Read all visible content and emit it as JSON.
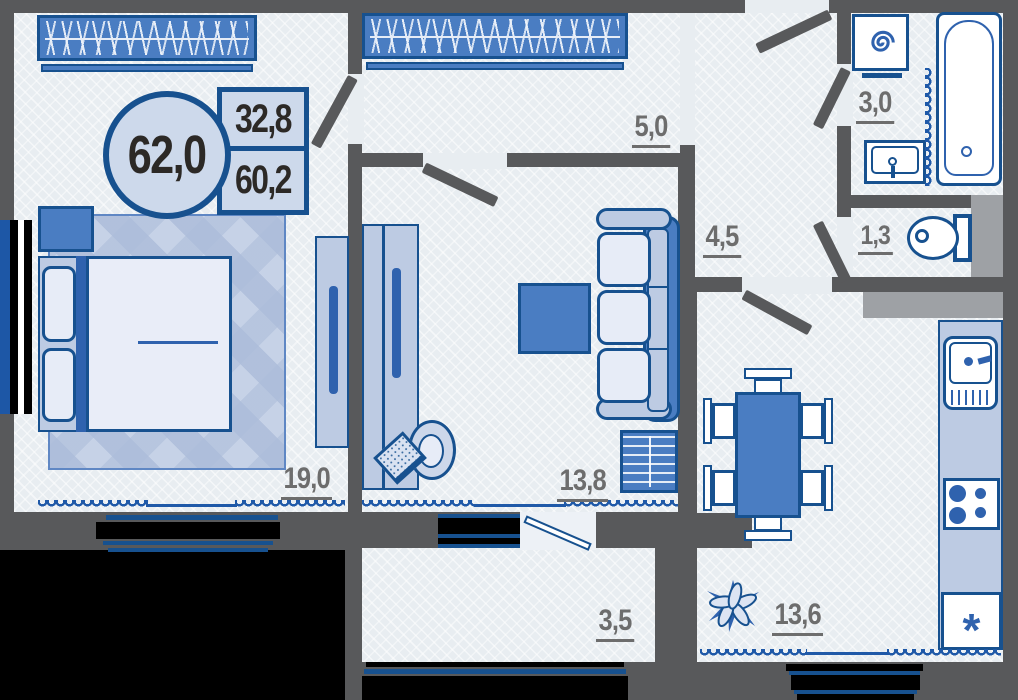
{
  "badge": {
    "total": "62,0",
    "area_top": "32,8",
    "area_bottom": "60,2"
  },
  "rooms": {
    "bedroom": {
      "area": "19,0"
    },
    "living": {
      "area": "13,8"
    },
    "corridor": {
      "area": "5,0"
    },
    "hallway": {
      "area": "4,5"
    },
    "bathroom": {
      "area": "3,0"
    },
    "wc": {
      "area": "1,3"
    },
    "kitchen": {
      "area": "13,6"
    },
    "loggia": {
      "area": "3,5"
    }
  },
  "icons": {
    "fridge_symbol": "*"
  },
  "colors": {
    "wall": "#58595b",
    "floor": "#e8edf1",
    "furniture_blue": "#4a7dc2",
    "outline_navy": "#17518f",
    "light_furniture": "#bdcbe3",
    "label_gray": "#6d6d6d",
    "badge_fill": "#cdd9eb",
    "window_wave": "#1f59a8",
    "shaft_gray": "#9ea1a5",
    "railing_black": "#000000"
  }
}
